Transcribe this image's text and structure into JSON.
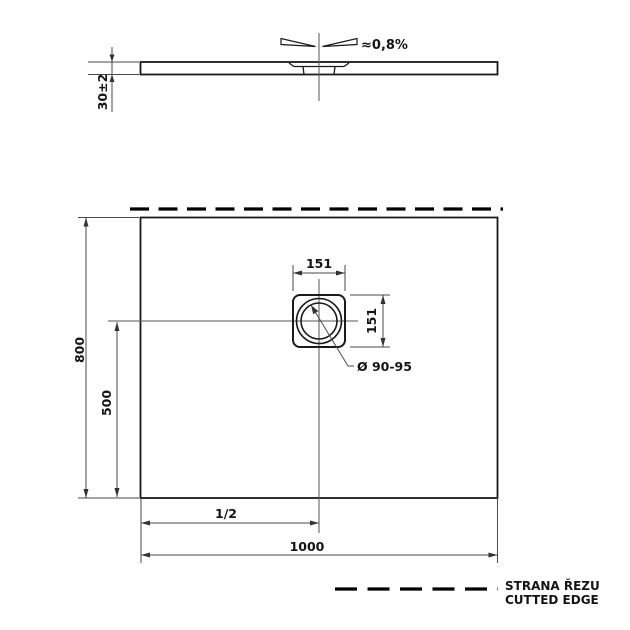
{
  "drawing": {
    "type": "technical-drawing",
    "subject": "shower tray dimensional drawing",
    "colors": {
      "background": "#ffffff",
      "outline": "#1a1a1a",
      "dimension": "#4a4a4a",
      "cut_edge": "#000000"
    },
    "section_view": {
      "slope_label": "≈0,8%",
      "height_dim": "30±2"
    },
    "plan_view": {
      "drain_width_dim": "151",
      "drain_height_dim": "151",
      "drain_diameter_label": "Ø 90-95",
      "side_length_dim": "800",
      "drain_offset_dim": "500",
      "half_width_dim": "1/2",
      "width_dim": "1000"
    },
    "legend": {
      "line1": "STRANA ŘEZU",
      "line2": "CUTTED EDGE"
    }
  }
}
